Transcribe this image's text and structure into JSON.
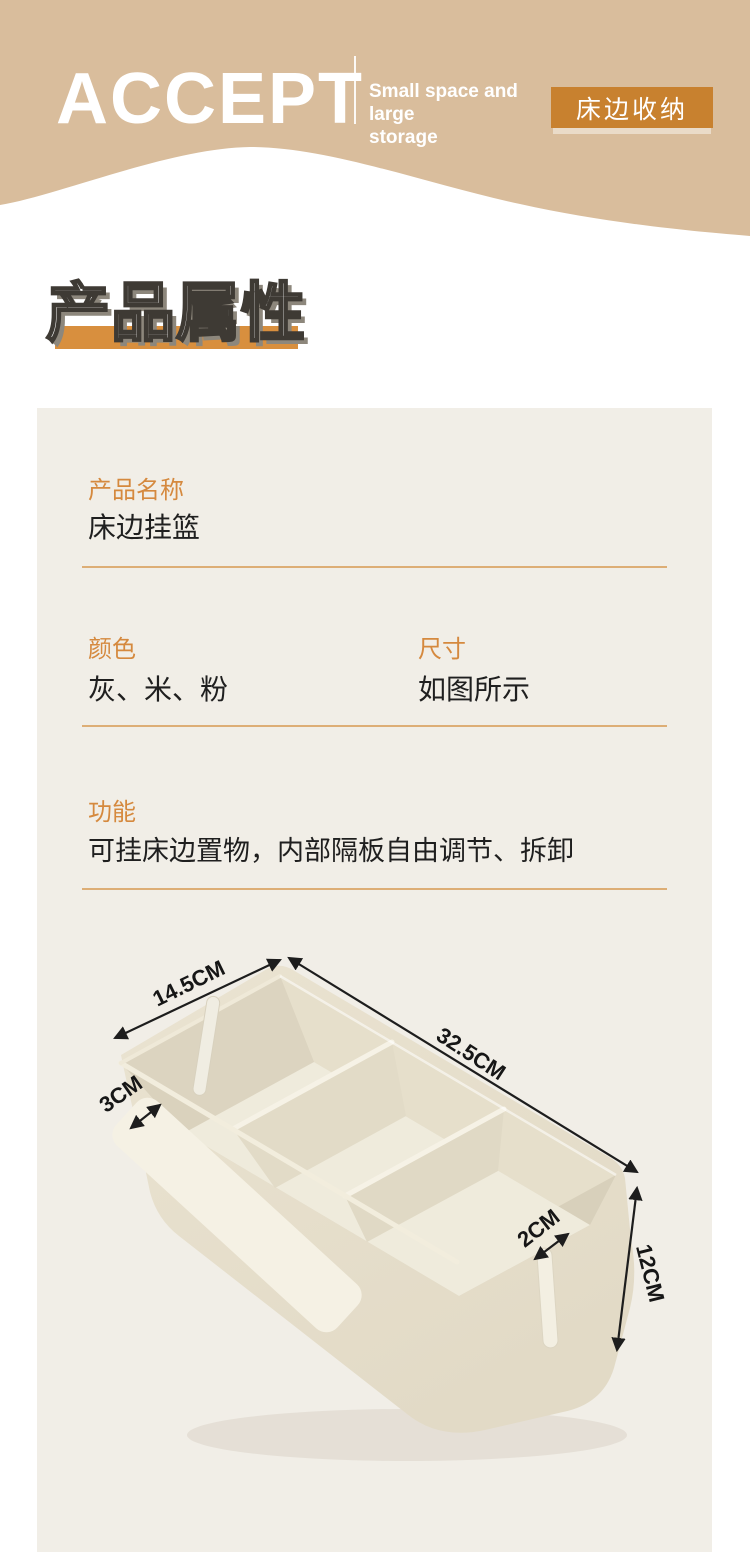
{
  "header": {
    "logo": "ACCEPT",
    "tagline_line1": "Small space and large",
    "tagline_line2": "storage",
    "badge": "床边收纳"
  },
  "title": {
    "text": "产品属性"
  },
  "attributes": {
    "name": {
      "label": "产品名称",
      "value": "床边挂篮"
    },
    "color": {
      "label": "颜色",
      "value": "灰、米、粉"
    },
    "size": {
      "label": "尺寸",
      "value": "如图所示"
    },
    "function": {
      "label": "功能",
      "value": "可挂床边置物，内部隔板自由调节、拆卸"
    }
  },
  "diagram": {
    "dimensions": {
      "side_width": "14.5CM",
      "front_length": "32.5CM",
      "hook_gap": "3CM",
      "slot_width": "2CM",
      "height": "12CM"
    }
  },
  "colors": {
    "header-tan": "#D9BD9C",
    "badge-orange": "#C8812F",
    "label-orange": "#D5893E",
    "divider-orange": "#D9A261",
    "panel-bg": "#F1EEE7",
    "title-bar-orange": "#D88F3E",
    "text-dark": "#1F1F1F",
    "basket-beige": "#E7E0CD"
  }
}
